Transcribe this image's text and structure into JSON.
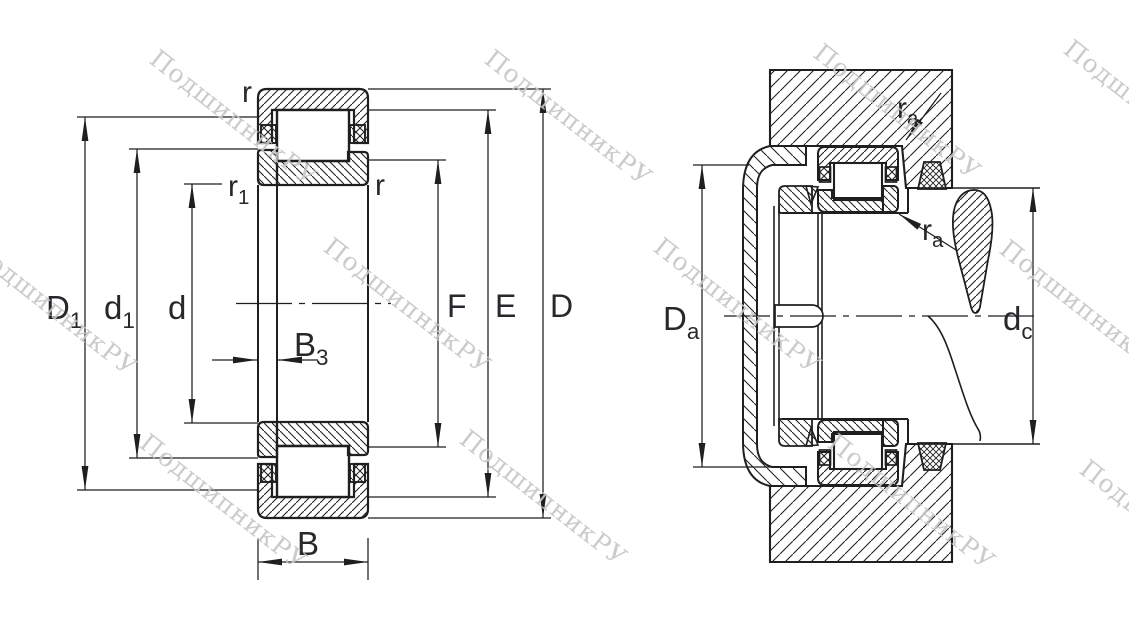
{
  "title": "bearing-technical-drawing",
  "watermark": {
    "text": "ПодшипникРУ",
    "color": "#c6c6c6"
  },
  "colors": {
    "line": "#1f1f1f",
    "label": "#26282c",
    "background": "#ffffff"
  },
  "left_view": {
    "description": "cylindrical-roller-bearing-cross-section",
    "labels": {
      "r_top": {
        "main": "r"
      },
      "r1": {
        "main": "r",
        "sub": "1"
      },
      "r_right": {
        "main": "r"
      },
      "D1": {
        "main": "D",
        "sub": "1"
      },
      "d1": {
        "main": "d",
        "sub": "1"
      },
      "d": {
        "main": "d"
      },
      "B3": {
        "main": "B",
        "sub": "3"
      },
      "B": {
        "main": "B"
      },
      "F": {
        "main": "F"
      },
      "E": {
        "main": "E"
      },
      "D": {
        "main": "D"
      }
    }
  },
  "right_view": {
    "description": "bearing-mounting-arrangement",
    "labels": {
      "ra_top": {
        "main": "r",
        "sub": "a"
      },
      "ra_bottom": {
        "main": "r",
        "sub": "a"
      },
      "Da": {
        "main": "D",
        "sub": "a"
      },
      "dc": {
        "main": "d",
        "sub": "c"
      }
    }
  }
}
